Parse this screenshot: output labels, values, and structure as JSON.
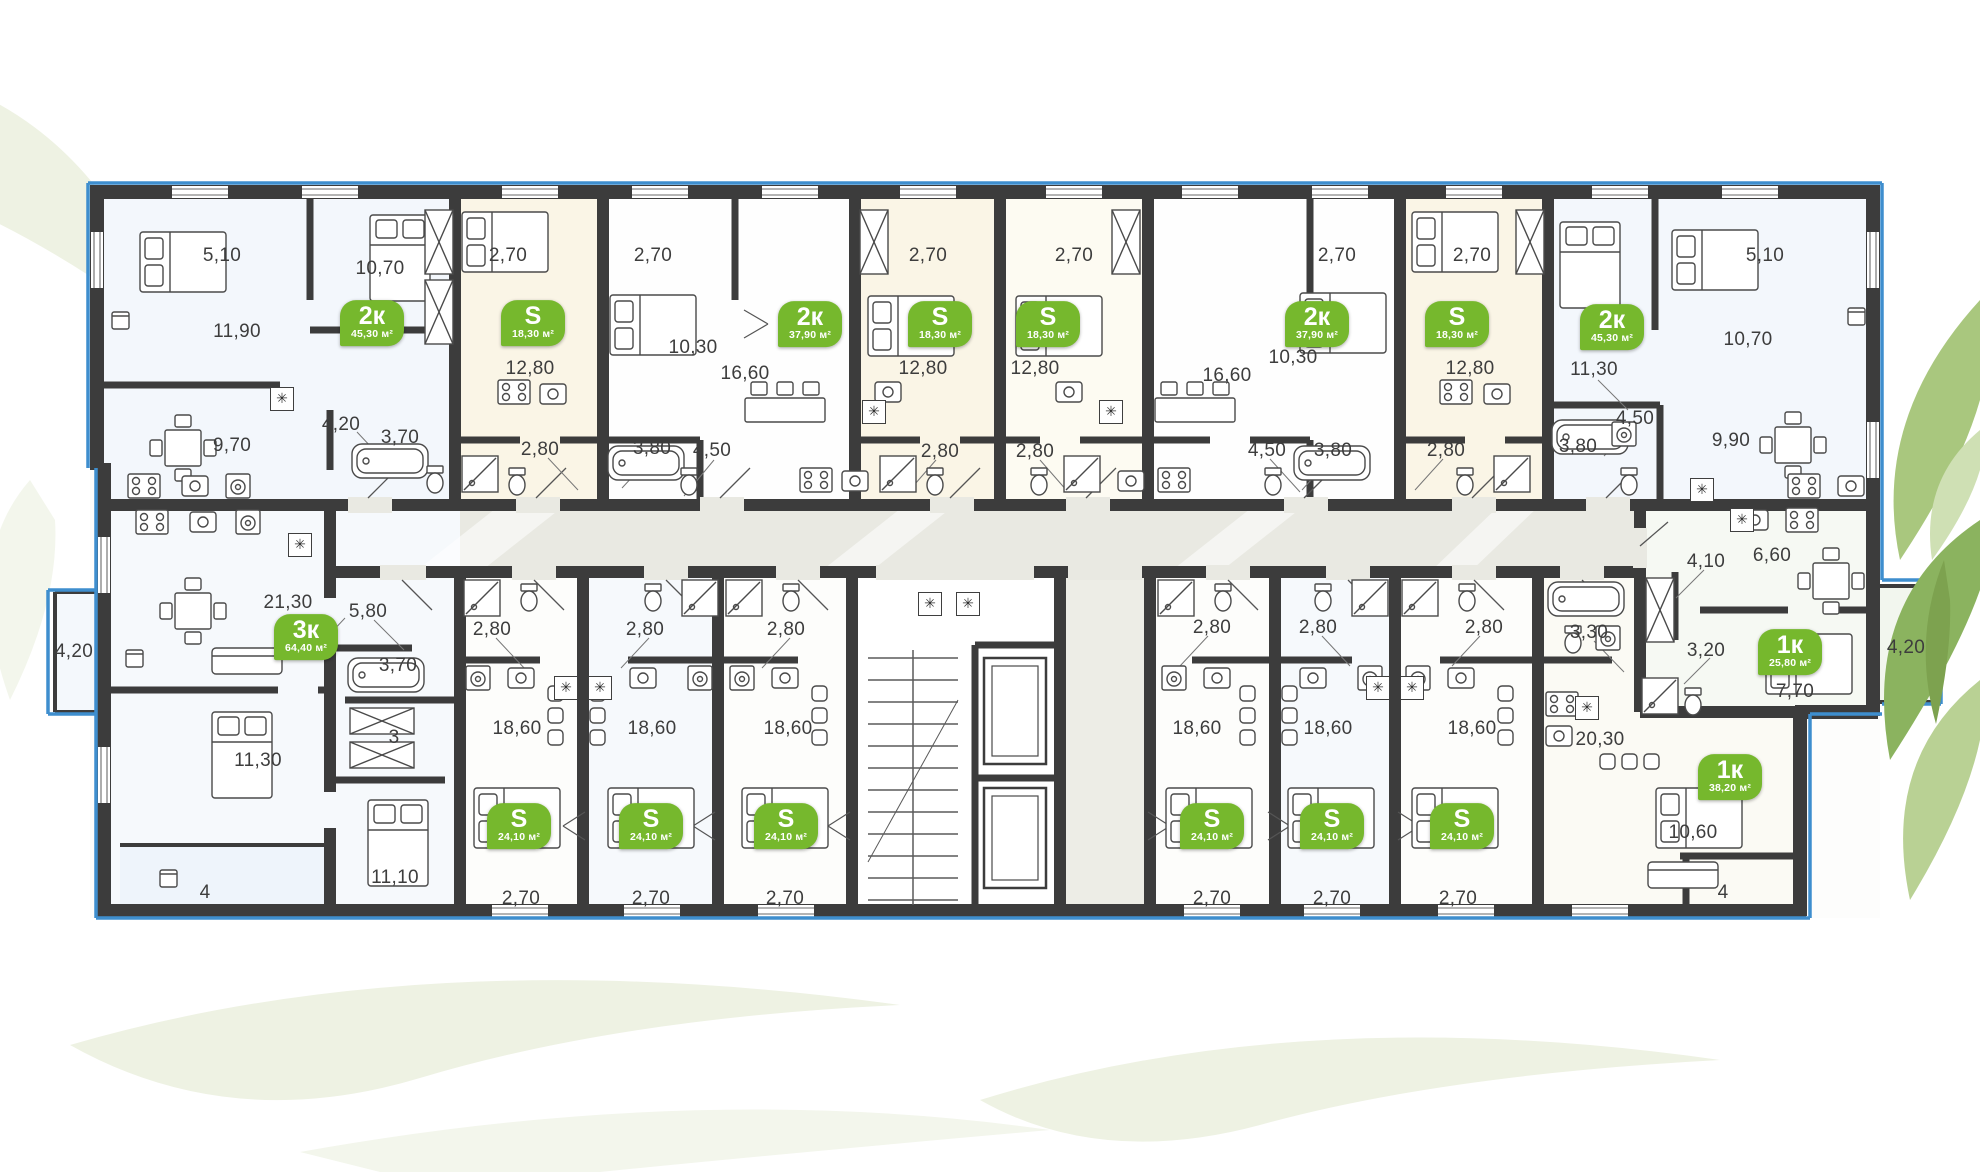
{
  "plan": {
    "colors": {
      "wall": "#3c3c3c",
      "accent_green": "#76b82d",
      "window_blue": "#3e8ece",
      "corridor": "#e9e9e2",
      "cream_room": "#faf5e6",
      "blue_room": "#f3f7fc"
    },
    "badges": [
      {
        "type": "2к",
        "area": "45,30 м²",
        "x": 372,
        "y": 323
      },
      {
        "type": "S",
        "area": "18,30 м²",
        "x": 533,
        "y": 323
      },
      {
        "type": "2к",
        "area": "37,90 м²",
        "x": 810,
        "y": 324
      },
      {
        "type": "S",
        "area": "18,30 м²",
        "x": 940,
        "y": 324
      },
      {
        "type": "S",
        "area": "18,30 м²",
        "x": 1048,
        "y": 324
      },
      {
        "type": "2к",
        "area": "37,90 м²",
        "x": 1317,
        "y": 324
      },
      {
        "type": "S",
        "area": "18,30 м²",
        "x": 1457,
        "y": 324
      },
      {
        "type": "2к",
        "area": "45,30 м²",
        "x": 1612,
        "y": 327
      },
      {
        "type": "3к",
        "area": "64,40 м²",
        "x": 306,
        "y": 637
      },
      {
        "type": "S",
        "area": "24,10 м²",
        "x": 519,
        "y": 826
      },
      {
        "type": "S",
        "area": "24,10 м²",
        "x": 651,
        "y": 826
      },
      {
        "type": "S",
        "area": "24,10 м²",
        "x": 786,
        "y": 826
      },
      {
        "type": "S",
        "area": "24,10 м²",
        "x": 1212,
        "y": 826
      },
      {
        "type": "S",
        "area": "24,10 м²",
        "x": 1332,
        "y": 826
      },
      {
        "type": "S",
        "area": "24,10 м²",
        "x": 1462,
        "y": 826
      },
      {
        "type": "1к",
        "area": "25,80 м²",
        "x": 1790,
        "y": 652
      },
      {
        "type": "1к",
        "area": "38,20 м²",
        "x": 1730,
        "y": 777
      }
    ],
    "dimensions": [
      {
        "t": "5,10",
        "x": 222,
        "y": 256
      },
      {
        "t": "10,70",
        "x": 380,
        "y": 269
      },
      {
        "t": "11,90",
        "x": 237,
        "y": 332
      },
      {
        "t": "9,70",
        "x": 232,
        "y": 446
      },
      {
        "t": "4,20",
        "x": 341,
        "y": 425
      },
      {
        "t": "3,70",
        "x": 400,
        "y": 438
      },
      {
        "t": "2,70",
        "x": 508,
        "y": 256
      },
      {
        "t": "12,80",
        "x": 530,
        "y": 369
      },
      {
        "t": "2,80",
        "x": 540,
        "y": 450
      },
      {
        "t": "2,70",
        "x": 653,
        "y": 256
      },
      {
        "t": "10,30",
        "x": 693,
        "y": 348
      },
      {
        "t": "16,60",
        "x": 745,
        "y": 374
      },
      {
        "t": "3,80",
        "x": 652,
        "y": 449
      },
      {
        "t": "4,50",
        "x": 712,
        "y": 451
      },
      {
        "t": "2,70",
        "x": 928,
        "y": 256
      },
      {
        "t": "12,80",
        "x": 923,
        "y": 369
      },
      {
        "t": "2,80",
        "x": 940,
        "y": 452
      },
      {
        "t": "2,70",
        "x": 1074,
        "y": 256
      },
      {
        "t": "12,80",
        "x": 1035,
        "y": 369
      },
      {
        "t": "2,80",
        "x": 1035,
        "y": 452
      },
      {
        "t": "2,70",
        "x": 1337,
        "y": 256
      },
      {
        "t": "10,30",
        "x": 1293,
        "y": 358
      },
      {
        "t": "16,60",
        "x": 1227,
        "y": 376
      },
      {
        "t": "4,50",
        "x": 1267,
        "y": 451
      },
      {
        "t": "3,80",
        "x": 1333,
        "y": 451
      },
      {
        "t": "2,70",
        "x": 1472,
        "y": 256
      },
      {
        "t": "12,80",
        "x": 1470,
        "y": 369
      },
      {
        "t": "2,80",
        "x": 1446,
        "y": 451
      },
      {
        "t": "5,10",
        "x": 1765,
        "y": 256
      },
      {
        "t": "10,70",
        "x": 1748,
        "y": 340
      },
      {
        "t": "11,30",
        "x": 1594,
        "y": 370
      },
      {
        "t": "4,50",
        "x": 1635,
        "y": 419
      },
      {
        "t": "3,80",
        "x": 1578,
        "y": 447
      },
      {
        "t": "9,90",
        "x": 1731,
        "y": 441
      },
      {
        "t": "21,30",
        "x": 288,
        "y": 603
      },
      {
        "t": "5,80",
        "x": 368,
        "y": 612
      },
      {
        "t": "4,20",
        "x": 74,
        "y": 652
      },
      {
        "t": "3,70",
        "x": 398,
        "y": 666
      },
      {
        "t": "3",
        "x": 394,
        "y": 738
      },
      {
        "t": "11,30",
        "x": 258,
        "y": 761
      },
      {
        "t": "11,10",
        "x": 395,
        "y": 878
      },
      {
        "t": "4",
        "x": 205,
        "y": 893
      },
      {
        "t": "2,80",
        "x": 492,
        "y": 630
      },
      {
        "t": "18,60",
        "x": 517,
        "y": 729
      },
      {
        "t": "2,70",
        "x": 521,
        "y": 899
      },
      {
        "t": "2,80",
        "x": 645,
        "y": 630
      },
      {
        "t": "18,60",
        "x": 652,
        "y": 729
      },
      {
        "t": "2,70",
        "x": 651,
        "y": 899
      },
      {
        "t": "2,80",
        "x": 786,
        "y": 630
      },
      {
        "t": "18,60",
        "x": 788,
        "y": 729
      },
      {
        "t": "2,70",
        "x": 785,
        "y": 899
      },
      {
        "t": "2,80",
        "x": 1212,
        "y": 628
      },
      {
        "t": "18,60",
        "x": 1197,
        "y": 729
      },
      {
        "t": "2,70",
        "x": 1212,
        "y": 899
      },
      {
        "t": "2,80",
        "x": 1318,
        "y": 628
      },
      {
        "t": "18,60",
        "x": 1328,
        "y": 729
      },
      {
        "t": "2,70",
        "x": 1332,
        "y": 899
      },
      {
        "t": "2,80",
        "x": 1484,
        "y": 628
      },
      {
        "t": "18,60",
        "x": 1472,
        "y": 729
      },
      {
        "t": "2,70",
        "x": 1458,
        "y": 899
      },
      {
        "t": "3,30",
        "x": 1589,
        "y": 633
      },
      {
        "t": "20,30",
        "x": 1600,
        "y": 740
      },
      {
        "t": "10,60",
        "x": 1693,
        "y": 833
      },
      {
        "t": "4",
        "x": 1723,
        "y": 893
      },
      {
        "t": "4,10",
        "x": 1706,
        "y": 562
      },
      {
        "t": "6,60",
        "x": 1772,
        "y": 556
      },
      {
        "t": "3,20",
        "x": 1706,
        "y": 651
      },
      {
        "t": "7,70",
        "x": 1795,
        "y": 692
      },
      {
        "t": "4,20",
        "x": 1906,
        "y": 648
      }
    ],
    "vents": [
      {
        "x": 282,
        "y": 399
      },
      {
        "x": 874,
        "y": 412
      },
      {
        "x": 1111,
        "y": 412
      },
      {
        "x": 1702,
        "y": 490
      },
      {
        "x": 300,
        "y": 545
      },
      {
        "x": 1742,
        "y": 520
      },
      {
        "x": 566,
        "y": 688
      },
      {
        "x": 600,
        "y": 688
      },
      {
        "x": 1378,
        "y": 688
      },
      {
        "x": 1412,
        "y": 688
      },
      {
        "x": 1587,
        "y": 708
      },
      {
        "x": 930,
        "y": 604
      },
      {
        "x": 968,
        "y": 604
      }
    ]
  }
}
